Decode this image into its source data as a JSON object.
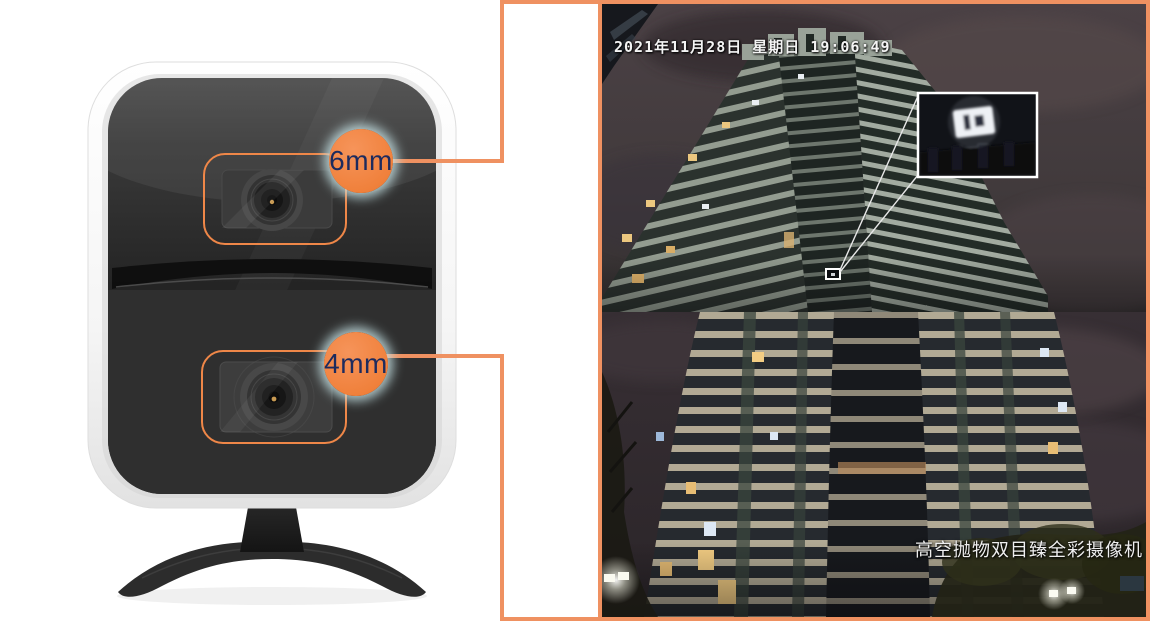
{
  "product": {
    "callouts": [
      {
        "label": "6mm"
      },
      {
        "label": "4mm"
      }
    ]
  },
  "monitor": {
    "timestamp": "2021年11月28日 星期日 19:06:49",
    "caption": "高空抛物双目臻全彩摄像机"
  },
  "colors": {
    "page_bg": "#ffffff",
    "accent_orange_circle": "#f0813c",
    "accent_orange_frame": "#ef9161",
    "lens_outline_orange": "#ef8748",
    "callout_text_navy": "#1d2b5e",
    "callout_glow": "#c6e2e4",
    "detection_frame_white": "#ffffff",
    "night_sky": "#43393d"
  }
}
